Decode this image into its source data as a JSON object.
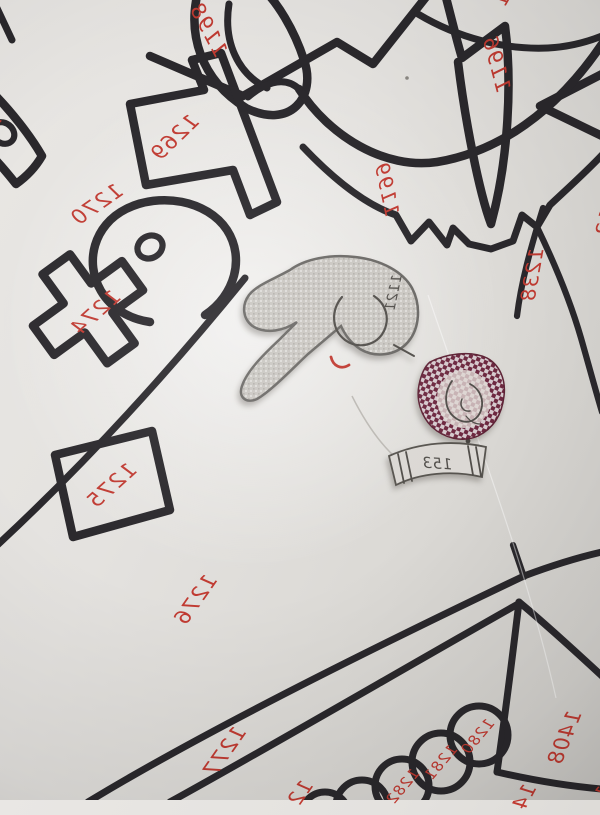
{
  "sheet": {
    "kind": "hand-drawn pattern sheet photograph",
    "note_visible_text_is_mirrored": true
  },
  "labels": [
    {
      "id": "t1198",
      "value": "1198"
    },
    {
      "id": "t1196",
      "value": "1196"
    },
    {
      "id": "t1199",
      "value": "1199"
    },
    {
      "id": "t1238",
      "value": "1238"
    },
    {
      "id": "t1269",
      "value": "1269"
    },
    {
      "id": "t1270",
      "value": "1270"
    },
    {
      "id": "t1274",
      "value": "1274"
    },
    {
      "id": "t1275",
      "value": "1275"
    },
    {
      "id": "t1276",
      "value": "1276"
    },
    {
      "id": "t1277",
      "value": "1277"
    },
    {
      "id": "t1280",
      "value": "1280"
    },
    {
      "id": "t1281",
      "value": "1281"
    },
    {
      "id": "t1282",
      "value": "1282"
    },
    {
      "id": "t1408",
      "value": "1408"
    },
    {
      "id": "p-top",
      "value": "1",
      "partial": true
    },
    {
      "id": "p-left",
      "value": "1",
      "partial": true
    },
    {
      "id": "p-right",
      "value": "12",
      "partial": true
    },
    {
      "id": "p-band",
      "value": "12",
      "partial": true
    },
    {
      "id": "p-mid",
      "value": "14",
      "partial": true
    },
    {
      "id": "p-corner",
      "value": "1",
      "partial": true
    },
    {
      "id": "pk1121",
      "value": "1121",
      "pencil": true
    },
    {
      "id": "ps153",
      "value": "153",
      "pencil": true
    }
  ],
  "colors": {
    "ink": "#2a282c",
    "red_ink": "#c03a31",
    "paper": "#e4e2df",
    "maroon_fabric": "#6d2840",
    "maroon_light": "#d6cace",
    "gray_fabric": "#cac7c2",
    "pencil": "#514e4a"
  }
}
